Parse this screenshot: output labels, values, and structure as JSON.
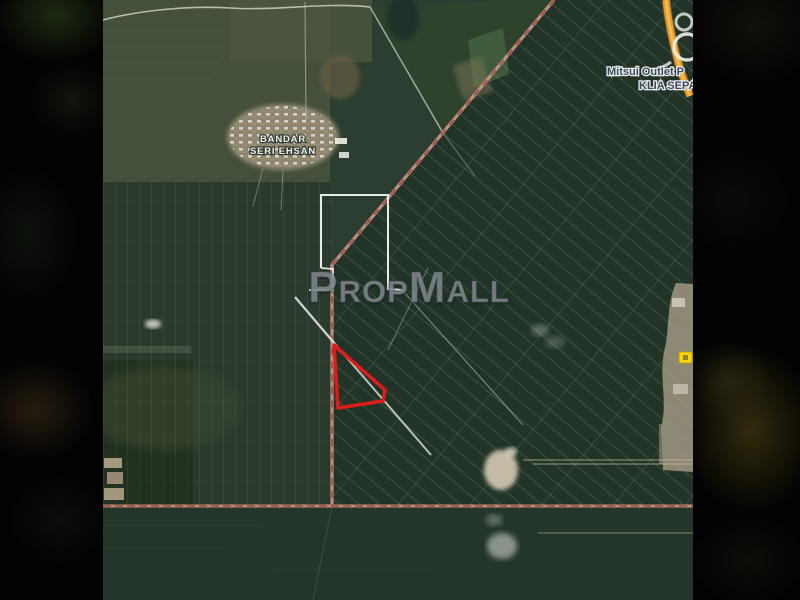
{
  "photo": {
    "map_labels": {
      "town_line1": "BANDAR",
      "town_line2": "SERI EHSAN",
      "poi_line1": "Mitsui Outlet P",
      "poi_line2": "KLIA SEPAN"
    },
    "watermark_part1": "Prop",
    "watermark_part2": "Mall",
    "colors": {
      "plot_outline_red": "#e01b1b",
      "boundary_white": "#f2f3ee",
      "boundary_road_pink": "#c99a8c",
      "boundary_road_dash_red": "#a83428",
      "highway_yellow": "#e89b28",
      "road_shield_yellow": "#ffd400"
    }
  }
}
